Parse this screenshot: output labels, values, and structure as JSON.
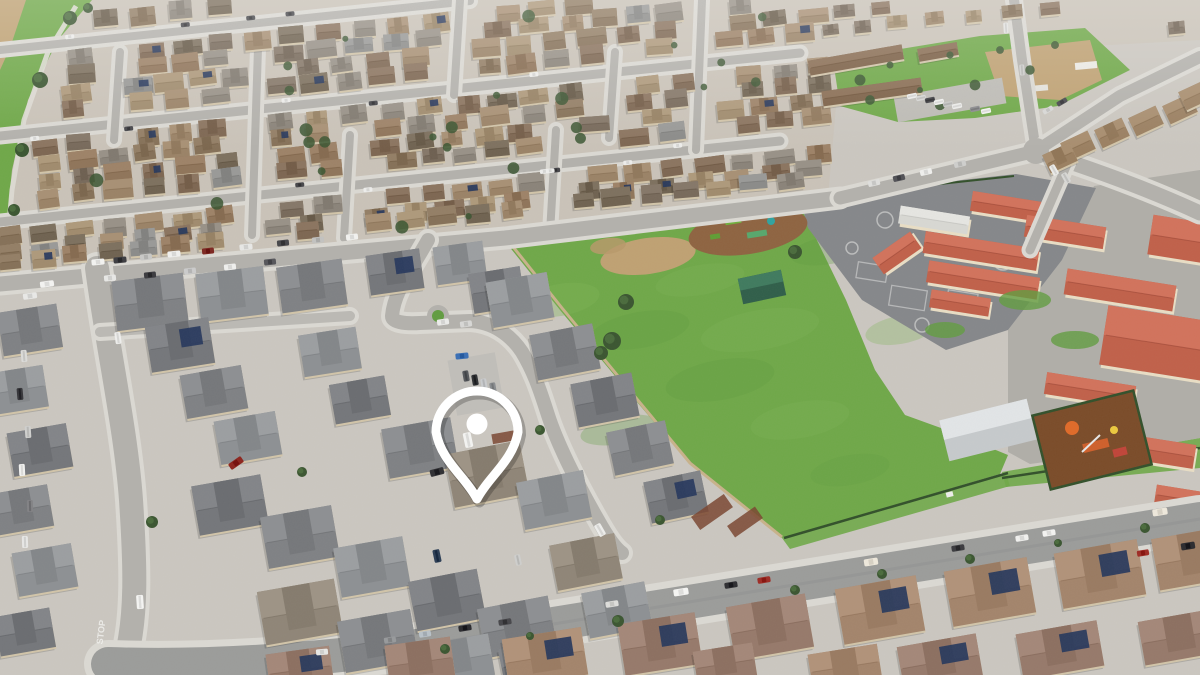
{
  "image": {
    "kind": "aerial-drone-photo",
    "description": "Aerial drone view of a suburban residential neighborhood: a white location pin marks a two-story home in a newer subdivision beside a large green school field, playground blacktop and terracotta-roofed school buildings; dense housing tract above, tree-lined streets with parked cars below.",
    "road_marking_text": "STOP",
    "pin": {
      "shape": "map-pin-outline",
      "color": "#ffffff",
      "cx": 477,
      "cy": 424,
      "r": 41,
      "tip_y": 499,
      "dot_r": 10.5,
      "stroke_w": 9
    },
    "regions": {
      "north": "residential-tract",
      "center": "subdivision-with-pin",
      "east": "school-campus-and-field",
      "south": "street-with-parked-cars",
      "northwest": "greenbelt-path"
    },
    "palette": {
      "concrete": "#cbc7c0",
      "concrete_light": "#dedbd4",
      "sidewalk": "#dbd9d3",
      "road": "#b3b1ac",
      "road_dark": "#9b9c9a",
      "grass": "#6fa848",
      "grass_light": "#7fb457",
      "grass_dark": "#619c40",
      "dirt": "#bfa172",
      "mulch": "#8e6340",
      "mulch_dark": "#7a4b28",
      "blacktop": "#85878a",
      "school_roof": "#c06049",
      "school_roof_dark": "#9c4534",
      "school_wall": "#e9dec5",
      "roof_brown": "#8f7459",
      "roof_tan": "#a3846b",
      "roof_gray": "#7f8184",
      "house_wall": "#d2c5a9",
      "tree": "#3a5530",
      "tree_light": "#4a6b3c",
      "solar": "#26375c",
      "wall_tan": "#c8b28a",
      "fence_green": "#32502a",
      "pin_white": "#ffffff"
    }
  }
}
